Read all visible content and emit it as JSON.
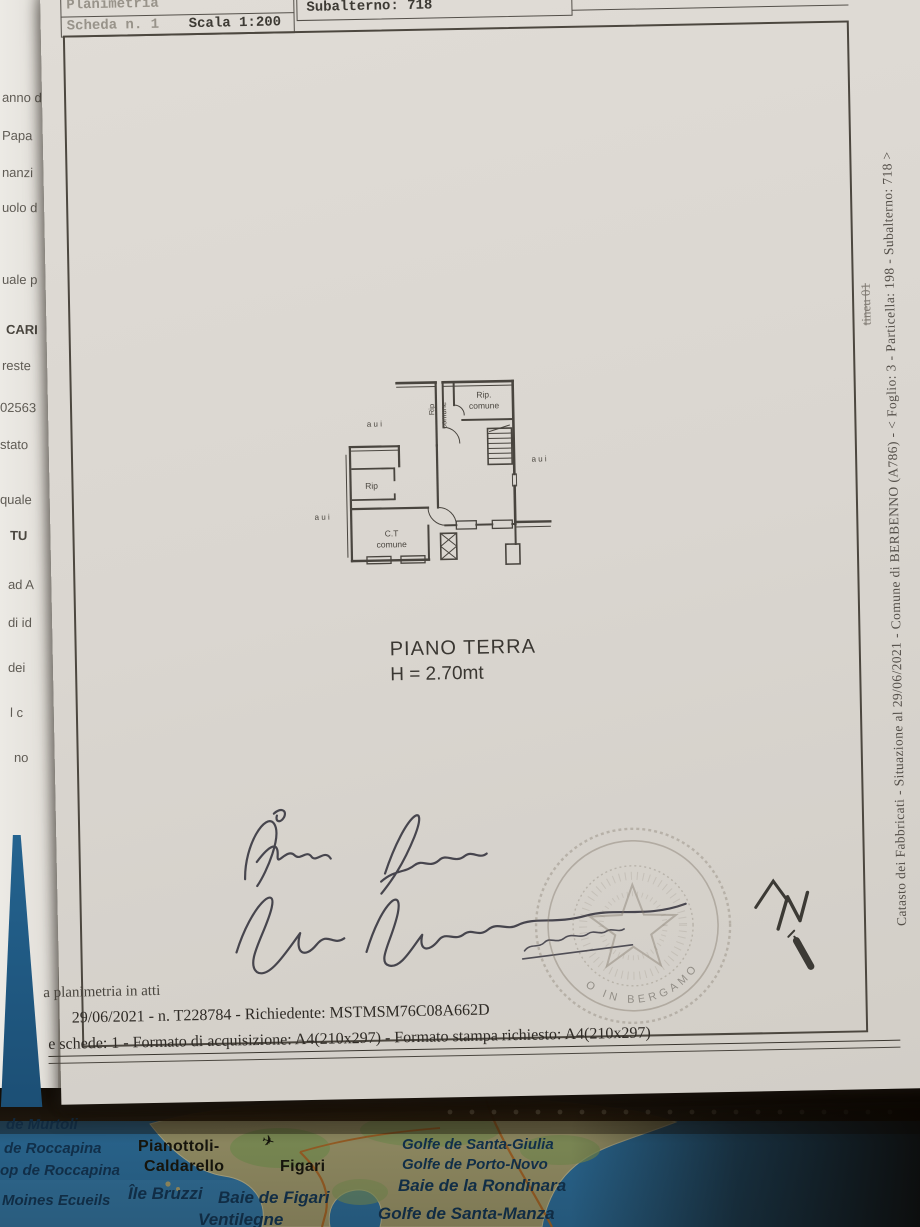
{
  "header": {
    "plan_label": "Planimetria",
    "sheet": "Scheda n. 1",
    "scale": "Scala 1:200",
    "particella": "Particella: 198",
    "subalterno": "Subalterno: 718",
    "prov": "Prov. Bergamo",
    "numero": "N. 1353"
  },
  "floor_plan": {
    "title": "PIANO TERRA",
    "height_label": "H = 2.70mt",
    "rooms": {
      "rip_dot": "Rip.",
      "comune": "comune",
      "rip": "Rip",
      "ct": "C.T",
      "aui": "a u i"
    }
  },
  "side": {
    "vertical_text": "Catasto dei Fabbricati - Situazione al 29/06/2021 - Comune di BERBENNO (A786) - < Foglio: 3 - Particella: 198 - Subalterno: 718 >",
    "annotation": "tineu 01"
  },
  "north": {
    "label": "N"
  },
  "stamp": {
    "arc_text": "O IN BERGAMO"
  },
  "footer": {
    "line1": "a planimetria in atti",
    "line2": "29/06/2021 - n. T228784 - Richiedente: MSTMSM76C08A662D",
    "line3": "e schede: 1 - Formato di acquisizione: A4(210x297) - Formato stampa richiesto: A4(210x297)"
  },
  "under_page": {
    "fragments": [
      "anno d",
      "Papa",
      "nanzi",
      "uolo d",
      "uale p",
      "CARI",
      "reste",
      "02563",
      "stato",
      "quale",
      "TU",
      "ad A",
      "di id",
      "dei",
      "l c",
      "no"
    ]
  },
  "map": {
    "airplane_icon": "✈",
    "labels": [
      "de Murtoli",
      "de Roccapina",
      "op de Roccapina",
      "Moines Ecueils",
      "Pianottoli-",
      "Caldarello",
      "Île Bruzzi",
      "Figari",
      "Baie de Figari",
      "Ventilegne",
      "Golfe de Santa-Giulia",
      "Golfe de Porto-Novo",
      "Baie de la Rondinara",
      "Golfe de Santa-Manza"
    ],
    "colors": {
      "sea": "#2e79ad",
      "land": "#b4ab76",
      "roads": "#b5702c",
      "water_label": "#113a5e"
    }
  }
}
